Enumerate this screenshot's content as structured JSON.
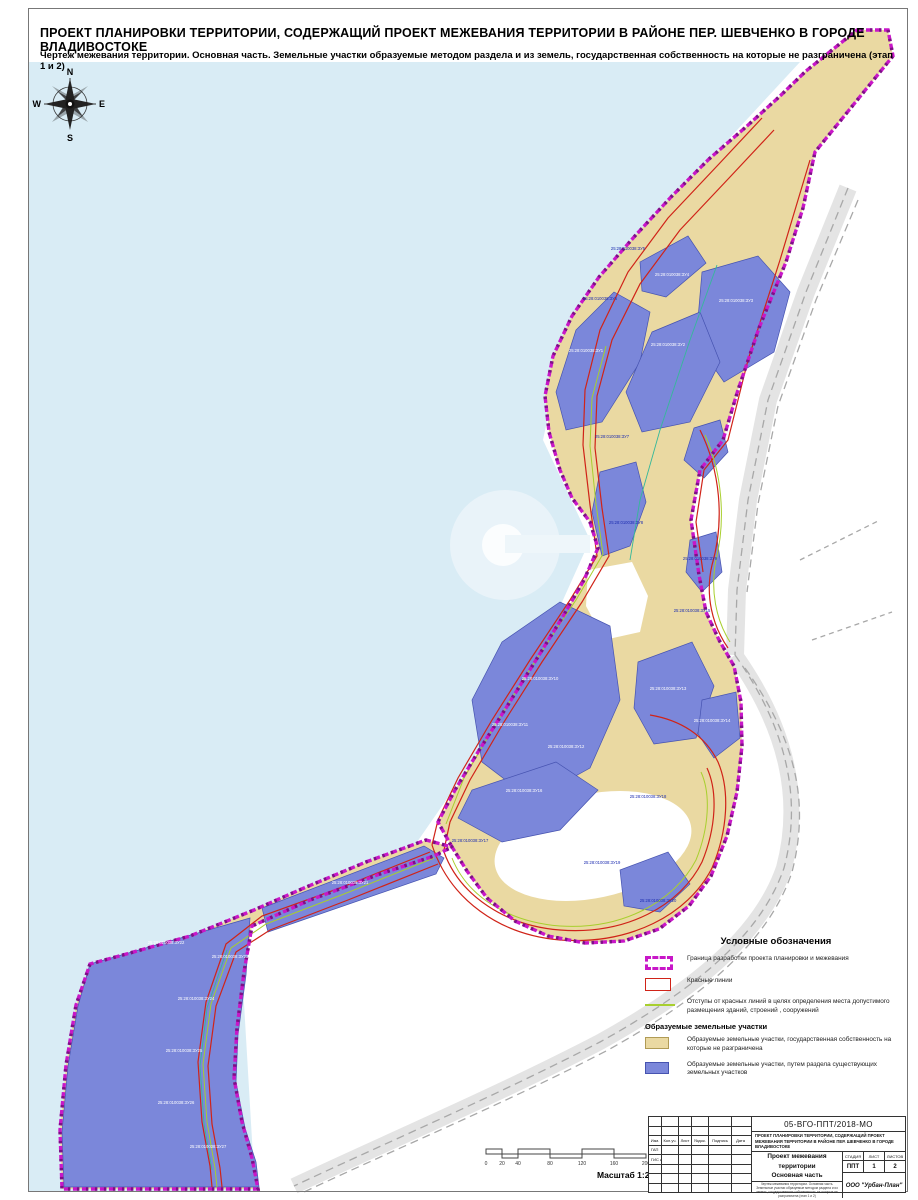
{
  "page": {
    "title": "ПРОЕКТ ПЛАНИРОВКИ ТЕРРИТОРИИ, СОДЕРЖАЩИЙ ПРОЕКТ МЕЖЕВАНИЯ ТЕРРИТОРИИ В РАЙОНЕ ПЕР. ШЕВЧЕНКО В ГОРОДЕ ВЛАДИВОСТОКЕ",
    "subtitle": "Чертеж межевания территории. Основная часть. Земельные участки образуемые методом раздела и из земель, государственная собственность на которые не разграничена (этап 1 и 2)"
  },
  "compass": {
    "n": "N",
    "s": "S",
    "e": "E",
    "w": "W"
  },
  "legend": {
    "title": "Условные обозначения",
    "items": [
      {
        "swatch": "boundary",
        "label": "Граница разработки проекта планировки и межевания"
      },
      {
        "swatch": "redline",
        "label": "Красные линии"
      },
      {
        "swatch": "greenline",
        "label": "Отступы от красных линий в целях определения места допустимого размещения зданий, строений , сооружений"
      },
      {
        "swatch": "header",
        "label": "Образуемые земельные участки"
      },
      {
        "swatch": "tan",
        "label": "Образуемые земельные участки, государственная собственность на которые не разграничена"
      },
      {
        "swatch": "blue",
        "label": "Образуемые земельные участки, путем раздела существующих земельных участков"
      }
    ]
  },
  "scalebar": {
    "ticks": [
      {
        "label": "0",
        "px": 0
      },
      {
        "label": "20",
        "px": 16
      },
      {
        "label": "40",
        "px": 32
      },
      {
        "label": "80",
        "px": 64
      },
      {
        "label": "120",
        "px": 96
      },
      {
        "label": "160",
        "px": 128
      },
      {
        "label": "200",
        "px": 160
      }
    ],
    "unit": "Метры",
    "caption": "Масштаб 1:2 000"
  },
  "stamp": {
    "doc_number": "05-ВГО-ППТ/2018-МО",
    "project_name": "ПРОЕКТ ПЛАНИРОВКИ ТЕРРИТОРИИ, СОДЕРЖАЩИЙ ПРОЕКТ МЕЖЕВАНИЯ ТЕРРИТОРИИ В РАЙОНЕ ПЕР. ШЕВЧЕНКО В ГОРОДЕ ВЛАДИВОСТОКЕ",
    "columns": [
      "Изм.",
      "Кол.уч.",
      "Лист",
      "№док.",
      "Подпись",
      "Дата"
    ],
    "roles": [
      "ГАП",
      "ГИС инж."
    ],
    "sheet_title_line1": "Проект межевания территории",
    "sheet_title_line2": "Основная часть",
    "stage_label": "СТАДИЯ",
    "sheet_label": "ЛИСТ",
    "sheets_label": "ЛИСТОВ",
    "stage": "ППТ",
    "sheet": "1",
    "sheets": "2",
    "description": "Чертеж межевания территории. Основная часть. Земельные участки образуемые методом раздела и из земель, государственная собственность на которые не разграничена (этап 1 и 2)",
    "company": "ООО \"Урбан-План\""
  },
  "map": {
    "colors": {
      "water": "#d9ecf5",
      "tan": "#ead9a2",
      "blue": "#7b87da",
      "boundary_magenta": "#c817c8",
      "boundary_purple": "#7d0f86",
      "red_line": "#d02318",
      "green_line": "#a8cf2e",
      "teal_line": "#35b89a",
      "road_fill": "#e4e4e4",
      "road_line": "#a8a8a8"
    },
    "parcel_labels": [
      {
        "t": "25:28:010038:ЗУ1",
        "x": 586,
        "y": 352,
        "c": "w"
      },
      {
        "t": "25:28:010038:ЗУ2",
        "x": 668,
        "y": 346,
        "c": "w"
      },
      {
        "t": "25:28:010038:ЗУ3",
        "x": 736,
        "y": 302,
        "c": "w"
      },
      {
        "t": "25:28:010038:ЗУ4",
        "x": 672,
        "y": 276,
        "c": "w"
      },
      {
        "t": "25:28:010038:ЗУ5",
        "x": 628,
        "y": 250,
        "c": "b"
      },
      {
        "t": "25:28:010038:ЗУ6",
        "x": 600,
        "y": 300,
        "c": "b"
      },
      {
        "t": "25:28:010038:ЗУ7",
        "x": 612,
        "y": 438,
        "c": "b"
      },
      {
        "t": "25:28:010038:ЗУ8",
        "x": 626,
        "y": 524,
        "c": "b"
      },
      {
        "t": "25:28:010038:ЗУ9",
        "x": 700,
        "y": 560,
        "c": "b"
      },
      {
        "t": "25:28:010038:ЗУ10",
        "x": 540,
        "y": 680,
        "c": "w"
      },
      {
        "t": "25:28:010038:ЗУ11",
        "x": 510,
        "y": 726,
        "c": "w"
      },
      {
        "t": "25:28:010038:ЗУ12",
        "x": 566,
        "y": 748,
        "c": "w"
      },
      {
        "t": "25:28:010038:ЗУ13",
        "x": 668,
        "y": 690,
        "c": "w"
      },
      {
        "t": "25:28:010038:ЗУ14",
        "x": 712,
        "y": 722,
        "c": "w"
      },
      {
        "t": "25:28:010038:ЗУ15",
        "x": 692,
        "y": 612,
        "c": "b"
      },
      {
        "t": "25:28:010038:ЗУ16",
        "x": 524,
        "y": 792,
        "c": "w"
      },
      {
        "t": "25:28:010038:ЗУ17",
        "x": 470,
        "y": 842,
        "c": "b"
      },
      {
        "t": "25:28:010038:ЗУ18",
        "x": 648,
        "y": 798,
        "c": "b"
      },
      {
        "t": "25:28:010038:ЗУ19",
        "x": 602,
        "y": 864,
        "c": "b"
      },
      {
        "t": "25:28:010038:ЗУ20",
        "x": 658,
        "y": 902,
        "c": "b"
      },
      {
        "t": "25:28:010038:ЗУ21",
        "x": 350,
        "y": 884,
        "c": "w"
      },
      {
        "t": "25:28:010038:ЗУ22",
        "x": 166,
        "y": 944,
        "c": "w"
      },
      {
        "t": "25:28:010038:ЗУ23",
        "x": 230,
        "y": 958,
        "c": "w"
      },
      {
        "t": "25:28:010038:ЗУ24",
        "x": 196,
        "y": 1000,
        "c": "w"
      },
      {
        "t": "25:28:010038:ЗУ25",
        "x": 184,
        "y": 1052,
        "c": "w"
      },
      {
        "t": "25:28:010038:ЗУ26",
        "x": 176,
        "y": 1104,
        "c": "w"
      },
      {
        "t": "25:28:010038:ЗУ27",
        "x": 208,
        "y": 1148,
        "c": "w"
      }
    ]
  }
}
